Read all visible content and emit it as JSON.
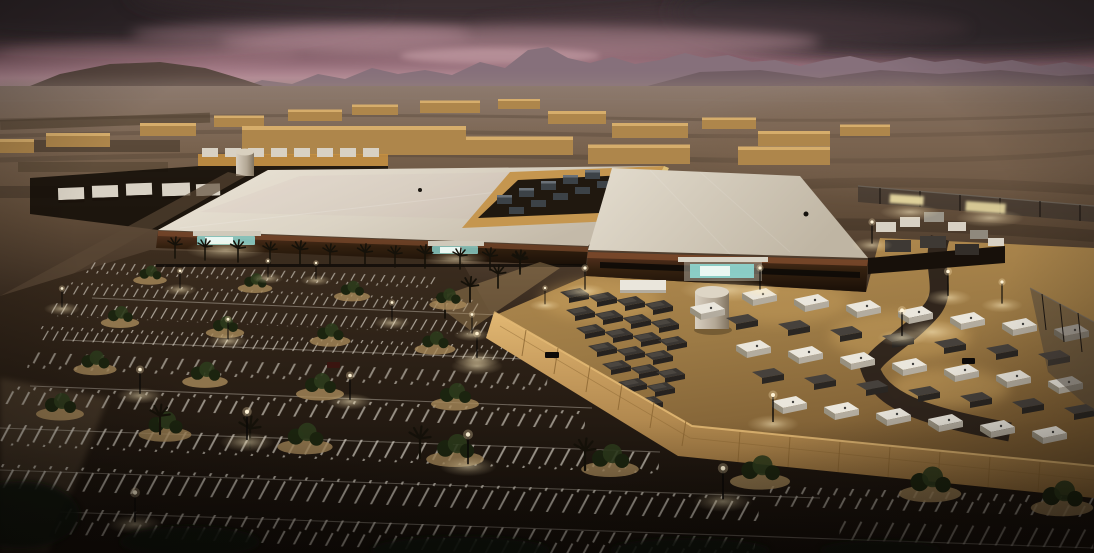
{
  "scene": {
    "type": "aerial-architectural-rendering",
    "time_of_day": "dusk",
    "setting": "desert-valley-with-mountain-horizon",
    "subject": "two-hall data center campus with equipment yard and parking lots"
  },
  "colors": {
    "sky_top": "#342a2d",
    "sky_cloud": "#463539",
    "sky_mid": "#8a646f",
    "sky_pink": "#b78d99",
    "sky_haze": "#a18b8a",
    "horizon_haze": "#9d8a80",
    "mtn_far": "#86707b",
    "mtn_near": "#6d5a61",
    "mtn_left": "#584740",
    "desert_haze": "#8d7a6e",
    "desert_mid": "#6f5943",
    "desert_dark": "#4c3a2b",
    "desert_fore": "#1e150e",
    "field": "#3f3226",
    "wh_wall": "#ae864b",
    "wh_lit": "#d6ad6b",
    "trailer": "#d8d1c4",
    "trailer_band": "#c8913f",
    "roof_lit": "#ece5d8",
    "roof_mid": "#d9d1c2",
    "roof_shade": "#c2b8a7",
    "rust": "#7c4a2c",
    "wall_dark": "#2c1b10",
    "glass": "#8ed8d2",
    "glow_white": "#eaf7f2",
    "pent_wall": "#c5964f",
    "pent_dark": "#20180f",
    "hvac": "#3c4247",
    "hvac_lit": "#6a7178",
    "pent_edge": "#e9c97c",
    "yard_lit": "#b68e51",
    "yard_dark": "#7c5d33",
    "wall_tan": "#c99e5f",
    "wall_tan_hi": "#e2b873",
    "wall_tan_lo": "#8f6a38",
    "wall_line": "#8a6531",
    "box_white": "#eae6dc",
    "box_side": "#b3ac9f",
    "box_end": "#97907f",
    "unit_dark": "#3a3632",
    "unit_darker": "#26221f",
    "unit_top": "#565149",
    "tank_lit": "#d8cfc0",
    "tank_shade": "#80735f",
    "asphalt_hi": "#3a2b1e",
    "asphalt": "#241a11",
    "asphalt_lo": "#130d08",
    "stripe": "#d6d0c4",
    "sand": "#a8895a",
    "tree_dark": "#1b240f",
    "tree_mid": "#2c3b1c",
    "palm": "#151109",
    "bush": "#10150a",
    "lamp_core": "#fff3d6",
    "lamp_glow": "#ffe9b8",
    "fence_dark": "#37312b",
    "fence_lit": "#efe0a6",
    "fence_metal": "#6e665c",
    "road": "#5a4835",
    "sidewalk": "#8a7356",
    "truck_dark": "#3e3934",
    "car_dark": "#0d0a08"
  }
}
